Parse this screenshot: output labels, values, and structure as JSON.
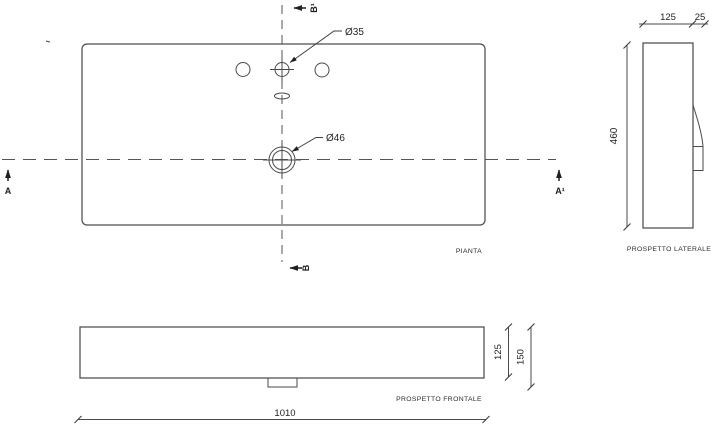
{
  "drawing": {
    "views": {
      "plan": {
        "label": "PIANTA"
      },
      "lateral": {
        "label": "PROSPETTO LATERALE"
      },
      "frontal": {
        "label": "PROSPETTO FRONTALE"
      }
    },
    "dimensions": {
      "overall_width": "1010",
      "depth": "460",
      "lateral_thickness": "125",
      "lateral_ledge": "25",
      "front_height": "125",
      "front_total_height": "150",
      "faucet_hole_diameter": "Ø35",
      "drain_hole_diameter": "Ø46"
    },
    "sections": {
      "a": "A",
      "a1": "A¹",
      "b": "B",
      "b1": "B¹"
    },
    "line_colors": {
      "outline": "#4d4d4d",
      "centerline": "#555555",
      "text": "#1f1f1f"
    }
  }
}
